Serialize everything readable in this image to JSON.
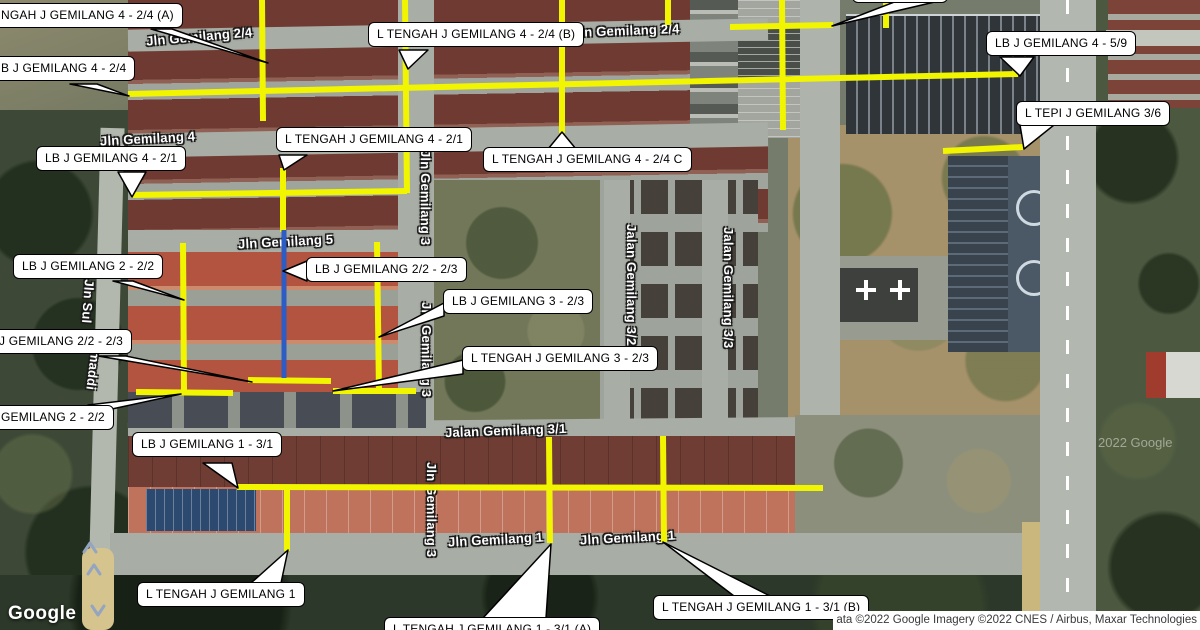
{
  "map": {
    "provider_logo": "Google",
    "watermark": "2022 Google",
    "attribution": "ata ©2022 Google Imagery ©2022 CNES / Airbus, Maxar Technologies",
    "colors": {
      "highlight_yellow": "#f2f500",
      "highlight_blue": "#2e5cc5",
      "label_bg": "#ffffff",
      "label_border": "#000000"
    }
  },
  "streets": [
    {
      "text": "Jln Gemilang 2/4"
    },
    {
      "text": "Jln Gemilang 2/4"
    },
    {
      "text": "Jln Gemilang 4"
    },
    {
      "text": "Jln Gemilang 5"
    },
    {
      "text": "Jln Gemilang 3"
    },
    {
      "text": "Jln Gemilang 3"
    },
    {
      "text": "Jln Gemilang 3"
    },
    {
      "text": "Jalan Gemilang 3/2"
    },
    {
      "text": "Jalan Gemilang 3/3"
    },
    {
      "text": "Jalan Gemilang 3/1"
    },
    {
      "text": "Jln Gemilang 1"
    },
    {
      "text": "Jln Gemilang 1"
    },
    {
      "text": "Jln Sul"
    },
    {
      "text": "maddi"
    }
  ],
  "annotations": [
    {
      "text": "NGAH J GEMILANG 4 - 2/4 (A)"
    },
    {
      "text": "B J GEMILANG 4 - 2/4"
    },
    {
      "text": "L TENGAH J GEMILANG 4 - 2/4 (B)"
    },
    {
      "text": "LB J GEMILANG 4 - 5/9"
    },
    {
      "text": "L TEPI J GEMILANG 3/6"
    },
    {
      "text": "L TENGAH J GEMILANG 4 - 2/1"
    },
    {
      "text": "LB J GEMILANG 4 - 2/1"
    },
    {
      "text": "L TENGAH J GEMILANG 4 - 2/4 C"
    },
    {
      "text": "LB J GEMILANG 2 - 2/2"
    },
    {
      "text": "LB J GEMILANG 2/2 - 2/3"
    },
    {
      "text": "LB J GEMILANG 3 - 2/3"
    },
    {
      "text": "L TENGAH J GEMILANG 3 - 2/3"
    },
    {
      "text": "J GEMILANG 2/2 - 2/3"
    },
    {
      "text": "GEMILANG 2 - 2/2"
    },
    {
      "text": "LB J GEMILANG 1 - 3/1"
    },
    {
      "text": "L TENGAH J GEMILANG 1"
    },
    {
      "text": "L TENGAH J GEMILANG 1 - 3/1 (A)"
    },
    {
      "text": "L TENGAH J GEMILANG 1 - 3/1 (B)"
    }
  ]
}
